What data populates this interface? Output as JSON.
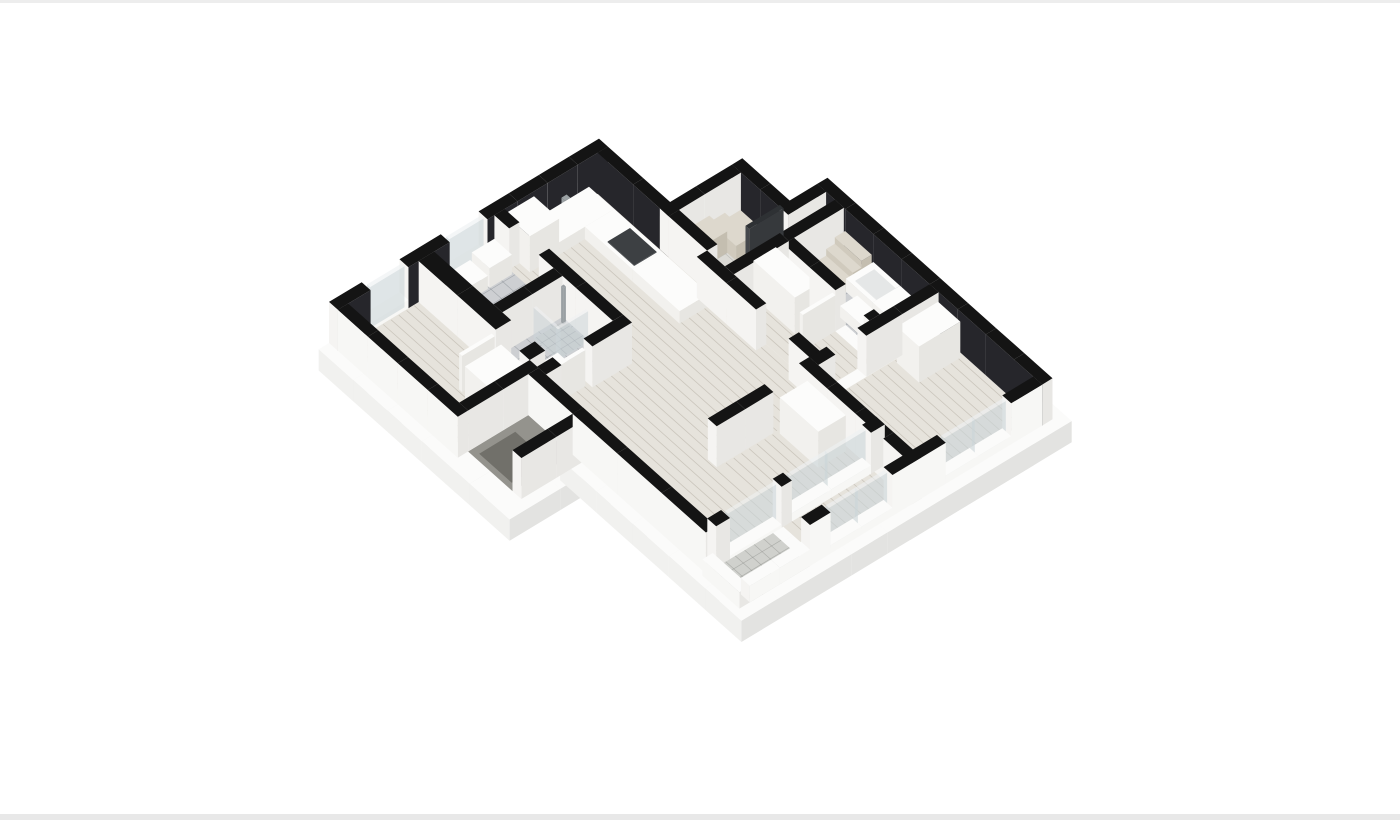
{
  "page": {
    "background": "#ffffff",
    "edge_strip_top": "#ededed",
    "edge_strip_bottom": "#e8e8e8"
  },
  "render": {
    "kind": "isometric-3d-floor-plan",
    "style": "cutaway dollhouse view, walls capped black",
    "wall_cap_color": "#141414"
  },
  "rooms": [
    {
      "id": "living-room",
      "floor": "wood"
    },
    {
      "id": "kitchen",
      "floor": "wood"
    },
    {
      "id": "entry-hall",
      "floor": "wood"
    },
    {
      "id": "hall-right-wing",
      "floor": "wood"
    },
    {
      "id": "bedroom-1",
      "floor": "wood"
    },
    {
      "id": "bedroom-2",
      "floor": "wood"
    },
    {
      "id": "bedroom-3",
      "floor": "wood"
    },
    {
      "id": "bathroom-1",
      "floor": "tile"
    },
    {
      "id": "bathroom-2-shower",
      "floor": "tile"
    },
    {
      "id": "laundry",
      "floor": "tile"
    },
    {
      "id": "pantry-closet",
      "floor": "tile"
    },
    {
      "id": "balcony",
      "floor": "tile"
    },
    {
      "id": "porch",
      "floor": "dark-tile"
    }
  ],
  "fixtures": [
    "bathtub",
    "double-sink-vanity",
    "toilet",
    "shower-glass",
    "washing-machine",
    "kitchen-sink",
    "cooktop",
    "fridge-cabinet",
    "wardrobes",
    "pantry-shelves",
    "window-glazing",
    "balcony-glass-doors",
    "open-doors"
  ],
  "palette": {
    "wallTop": "#141414",
    "innerDark": "#26262b",
    "faceL": "#f5f4f2",
    "faceD": "#e8e7e4",
    "outer": "#f7f7f5",
    "slabTop": "#fbfbfa",
    "slabL": "#f1f1ef",
    "slabD": "#e3e3e1",
    "wood": "#e6e3dc",
    "woodLine": "rgba(158,150,136,0.38)",
    "tile": "#cdcfd2",
    "tileLine": "rgba(120,126,132,0.45)",
    "tileLight": "#dbdad5",
    "tileLightLine": "rgba(150,150,145,0.4)",
    "tileSmall": "#c6c9cb",
    "tileBalcony": "#d0d1cd",
    "balconyLine": "rgba(140,142,138,0.5)",
    "porch": "#94938d",
    "porchMat": "#71706a",
    "white": "#fcfcfb",
    "whiteL": "#f2f1ee",
    "whiteD": "#e7e6e2",
    "insetTop": "#e5e7e7",
    "beigeT": "#ddd8cd",
    "beigeL": "#d0cabd",
    "beigeD": "#c4beb0",
    "cooktop": "#3d4043",
    "steel": "#9aa0a3",
    "glass": "#ccd5d9",
    "glassTop": "#eef1f2",
    "doorDarkTop": "#2e3134",
    "doorDarkL": "#45484c",
    "doorDarkR": "#36393c"
  }
}
